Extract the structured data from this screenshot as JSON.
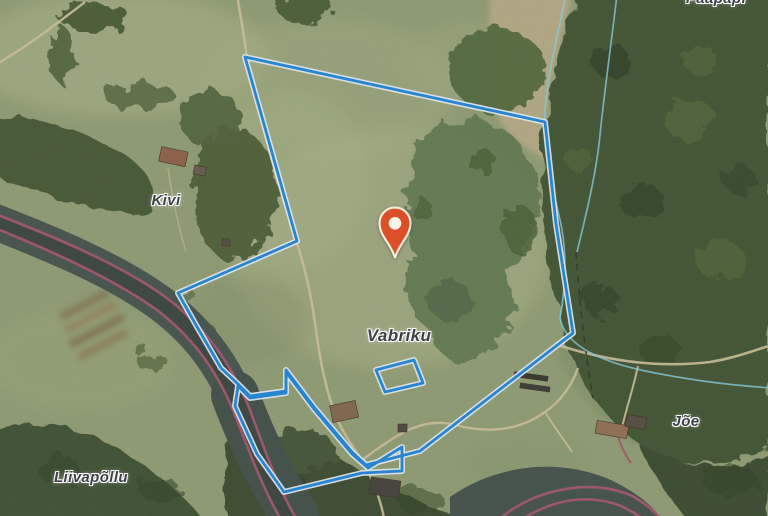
{
  "map": {
    "type": "satellite-map-with-parcel-overlay",
    "place_labels": [
      {
        "id": "paapapi",
        "text": "Paapapi"
      },
      {
        "id": "kivi",
        "text": "Kivi"
      },
      {
        "id": "vabriku",
        "text": "Vabriku"
      },
      {
        "id": "joe",
        "text": "Jõe"
      },
      {
        "id": "liivapollu",
        "text": "Liivapõllu"
      }
    ],
    "marker": {
      "label": "location-pin",
      "color": "#dc5029"
    },
    "overlay_colors": {
      "parcel_boundary": "#2b90e0",
      "parcel_casing": "#edf5fc",
      "road": "#b06078",
      "stream": "#90d8e8",
      "footpath": "#d8cba4",
      "cadastral_dash": "#3c4236"
    }
  }
}
